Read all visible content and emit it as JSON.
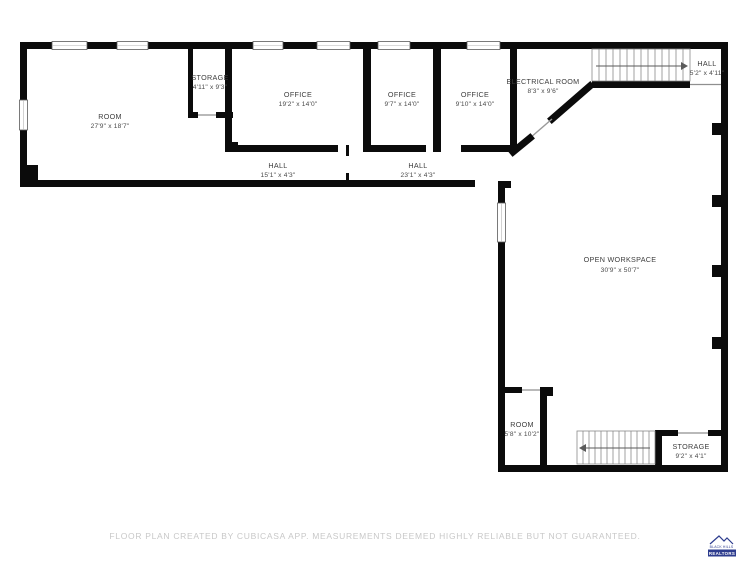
{
  "floor_plan": {
    "wall_color": "#0b0b0b",
    "rooms": [
      {
        "id": "room-main",
        "name": "ROOM",
        "dims": "27'9\" x 18'7\""
      },
      {
        "id": "storage-top",
        "name": "STORAGE",
        "dims": "4'11\" x 9'3\""
      },
      {
        "id": "office-1",
        "name": "OFFICE",
        "dims": "19'2\" x 14'0\""
      },
      {
        "id": "office-2",
        "name": "OFFICE",
        "dims": "9'7\" x 14'0\""
      },
      {
        "id": "office-3",
        "name": "OFFICE",
        "dims": "9'10\" x 14'0\""
      },
      {
        "id": "electrical-room",
        "name": "ELECTRICAL ROOM",
        "dims": "8'3\" x 9'6\""
      },
      {
        "id": "hall-top-right",
        "name": "HALL",
        "dims": "5'2\" x 4'11\""
      },
      {
        "id": "hall-west",
        "name": "HALL",
        "dims": "15'1\" x 4'3\""
      },
      {
        "id": "hall-east",
        "name": "HALL",
        "dims": "23'1\" x 4'3\""
      },
      {
        "id": "open-workspace",
        "name": "OPEN WORKSPACE",
        "dims": "30'9\" x 50'7\""
      },
      {
        "id": "room-bottom",
        "name": "ROOM",
        "dims": "5'8\" x 10'2\""
      },
      {
        "id": "storage-bottom",
        "name": "STORAGE",
        "dims": "9'2\" x 4'1\""
      }
    ]
  },
  "footer": {
    "disclaimer": "FLOOR PLAN CREATED BY CUBICASA APP. MEASUREMENTS DEEMED HIGHLY RELIABLE BUT NOT GUARANTEED."
  },
  "logo": {
    "name": "BLACK HILLS",
    "type": "REALTORS",
    "color": "#2d3c8e"
  }
}
